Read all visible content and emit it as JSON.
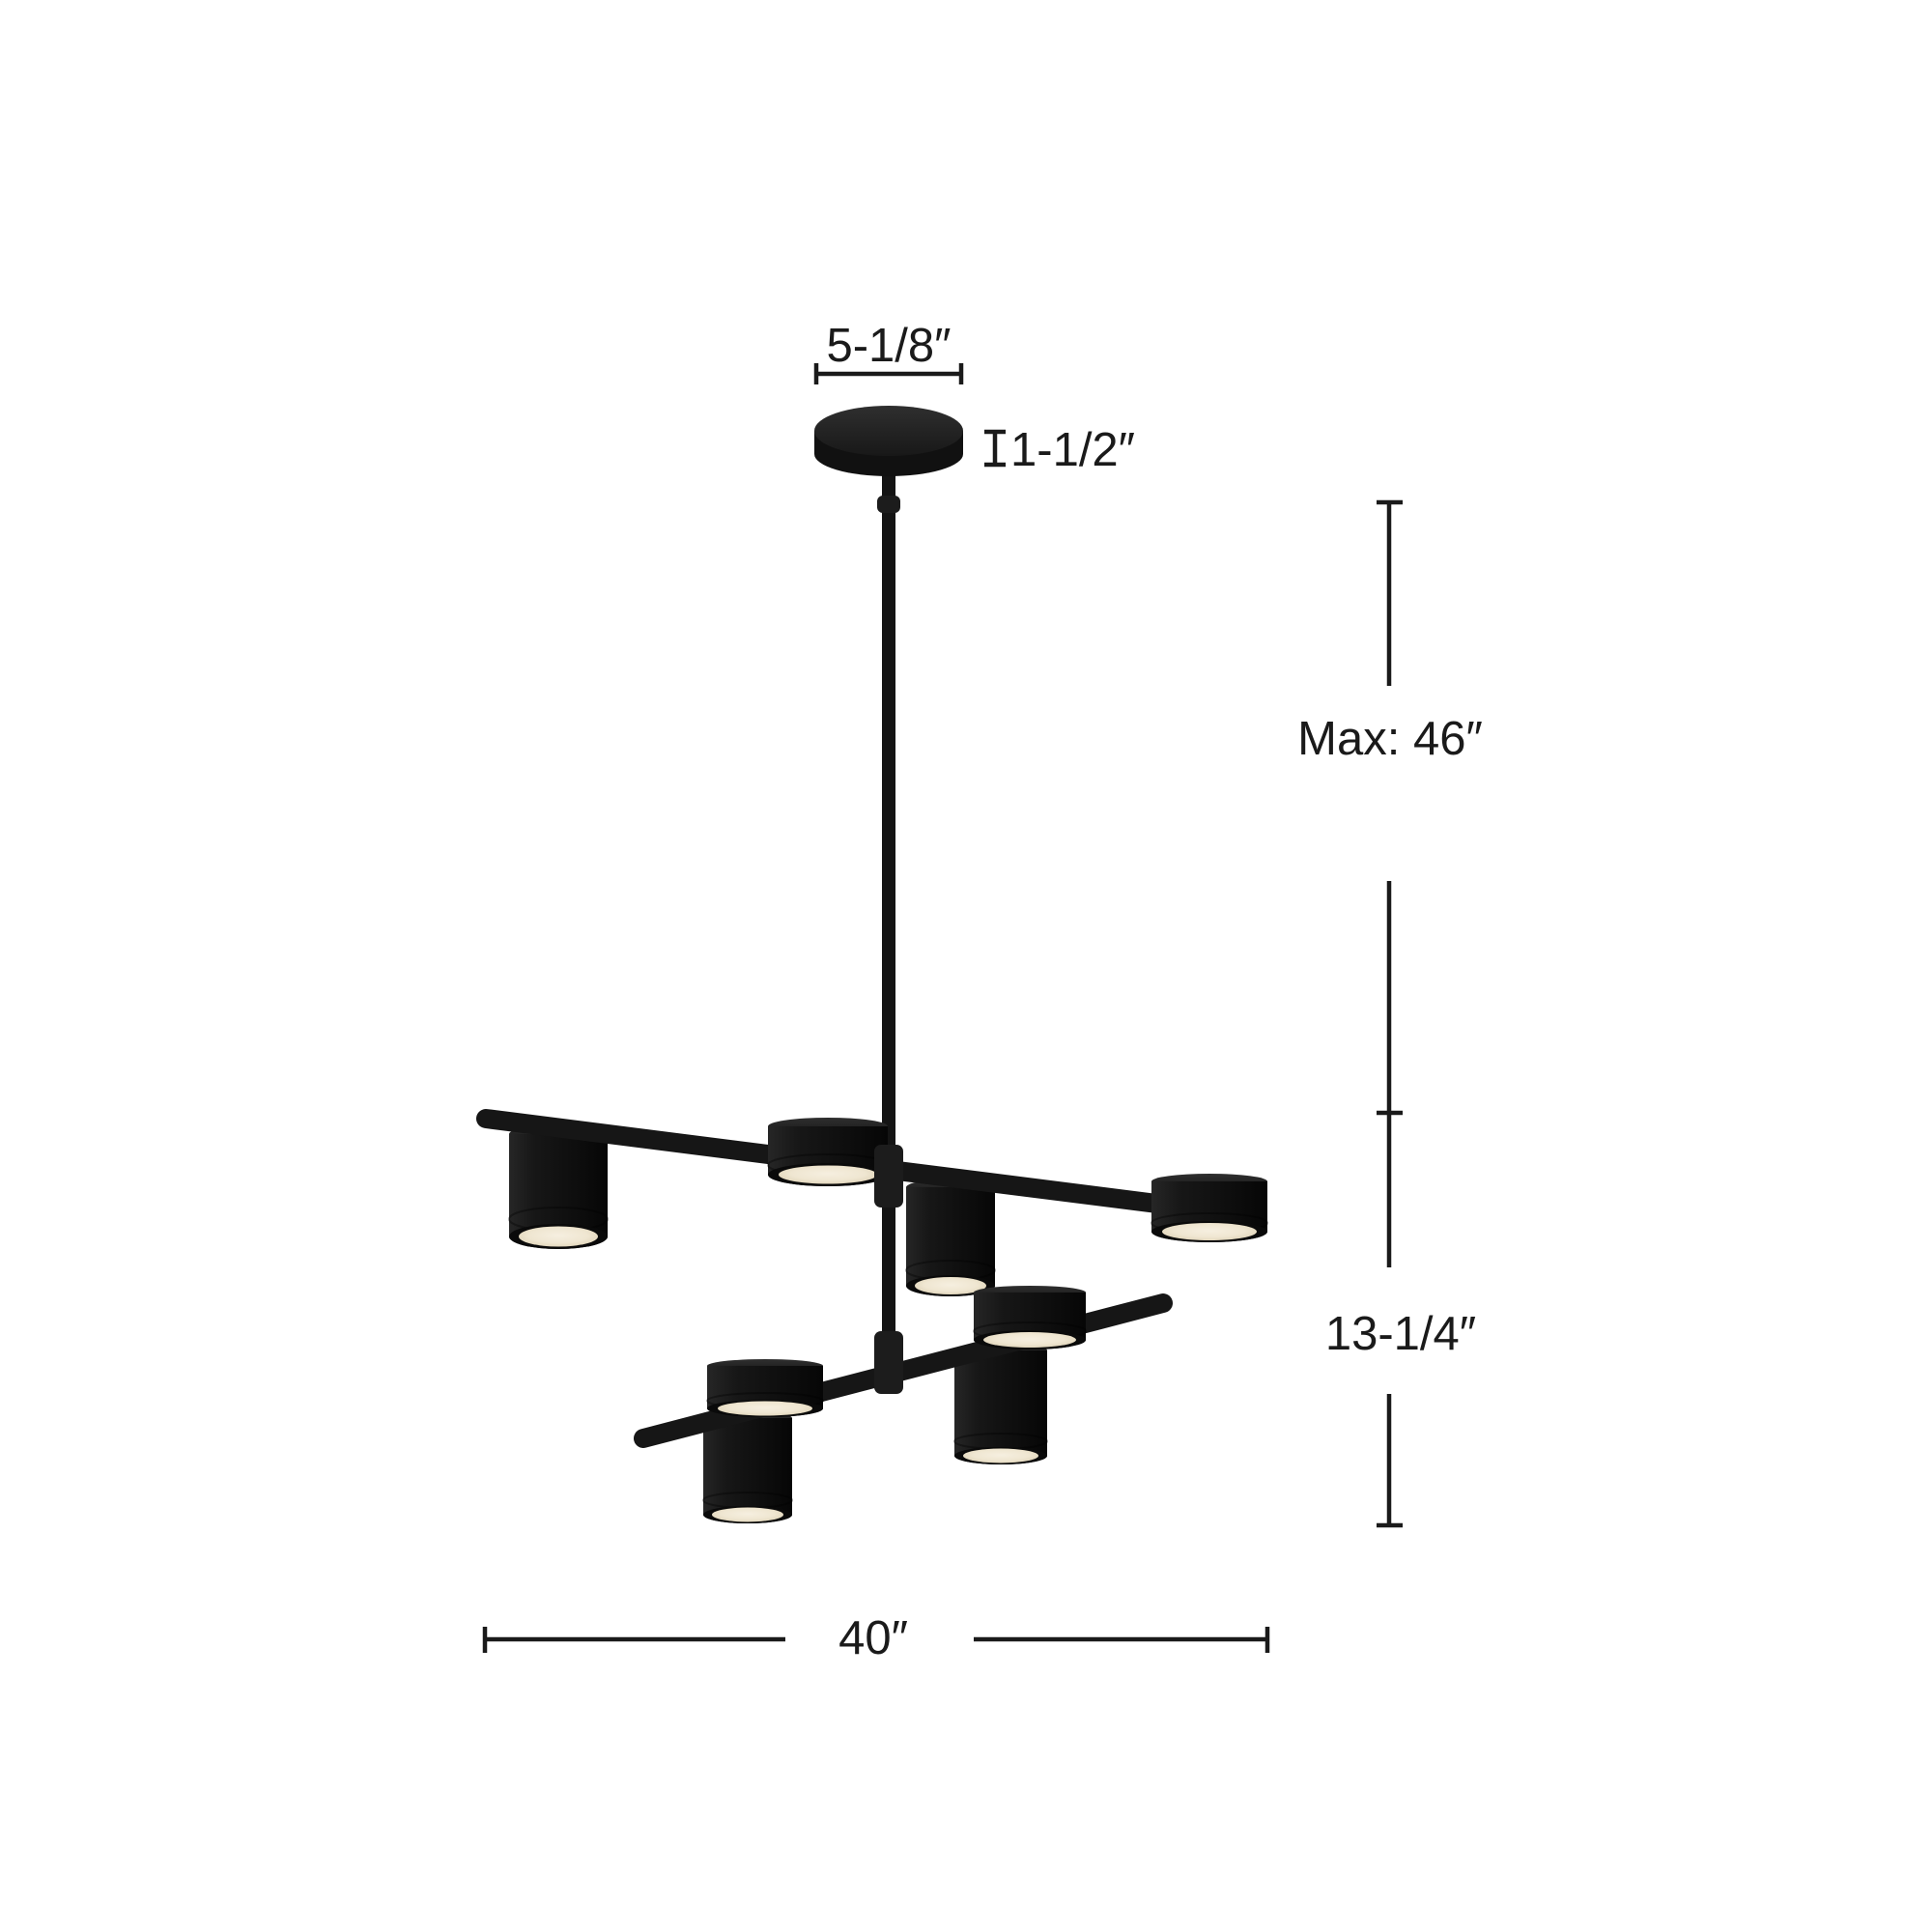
{
  "diagram": {
    "title": "chandelier-dimension-diagram",
    "dimensions": {
      "canopy_width": "5-1/8″",
      "canopy_height": "1-1/2″",
      "max_drop": "Max: 46″",
      "fixture_height": "13-1/4″",
      "fixture_width": "40″"
    },
    "fixture": {
      "tiers": 2,
      "puck_lights": 4,
      "cylinder_lights": 4,
      "lights_total": 8
    },
    "colors": {
      "background": "#ffffff",
      "dimension": "#1a1a1a",
      "fixture": "#121212",
      "lens": "#efe6d1"
    }
  }
}
